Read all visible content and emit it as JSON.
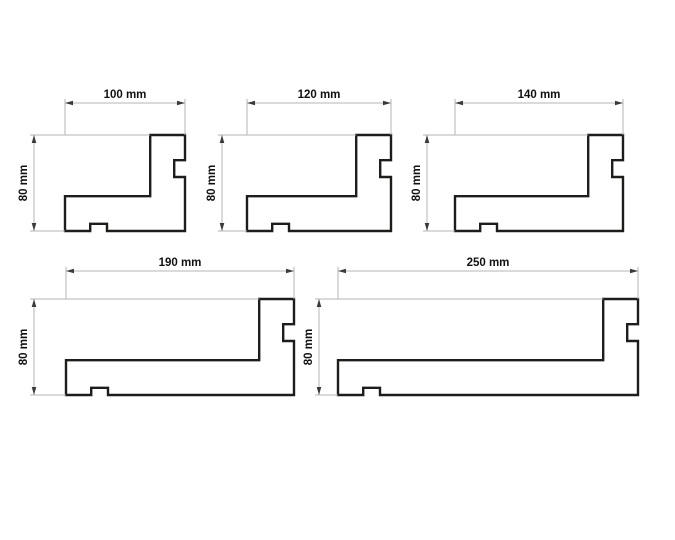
{
  "canvas": {
    "width": 675,
    "height": 540,
    "background": "#ffffff"
  },
  "style": {
    "outline_color": "#1d1d1b",
    "outline_width": 2.4,
    "dimension_line_color": "#b5b5b5",
    "arrow_color": "#3a3a3a",
    "text_color": "#111111",
    "scale_px_per_mm": 1.2
  },
  "geometry_mm": {
    "height": 80,
    "right_section_width": 29,
    "right_notch": {
      "top": 21,
      "bottom": 35,
      "depth": 9
    },
    "left_section_top": 51,
    "bottom_notch": {
      "left": 21,
      "right": 35,
      "height": 6
    }
  },
  "profiles": [
    {
      "id": "profile-100mm",
      "width_mm": 100,
      "width_label": "100 mm",
      "height_label": "80 mm",
      "origin_px": {
        "x": 65,
        "y": 135
      },
      "width_dim_y": 103,
      "height_dim_x": 34
    },
    {
      "id": "profile-120mm",
      "width_mm": 120,
      "width_label": "120 mm",
      "height_label": "80 mm",
      "origin_px": {
        "x": 247,
        "y": 135
      },
      "width_dim_y": 103,
      "height_dim_x": 222
    },
    {
      "id": "profile-140mm",
      "width_mm": 140,
      "width_label": "140 mm",
      "height_label": "80 mm",
      "origin_px": {
        "x": 455,
        "y": 135
      },
      "width_dim_y": 103,
      "height_dim_x": 427
    },
    {
      "id": "profile-190mm",
      "width_mm": 190,
      "width_label": "190 mm",
      "height_label": "80 mm",
      "origin_px": {
        "x": 66,
        "y": 299
      },
      "width_dim_y": 271,
      "height_dim_x": 34
    },
    {
      "id": "profile-250mm",
      "width_mm": 250,
      "width_label": "250 mm",
      "height_label": "80 mm",
      "origin_px": {
        "x": 338,
        "y": 299
      },
      "width_dim_y": 271,
      "height_dim_x": 319
    }
  ]
}
